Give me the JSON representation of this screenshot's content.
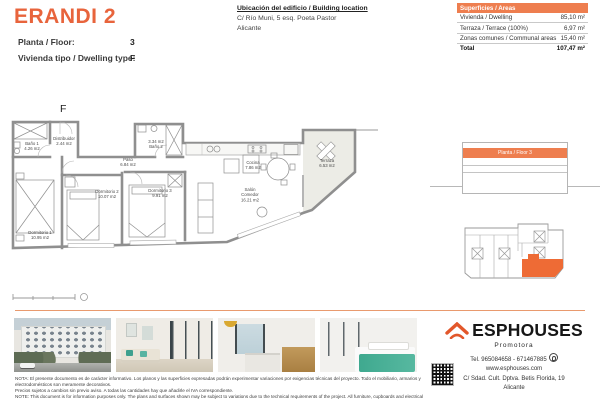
{
  "header": {
    "title": "ERANDI 2",
    "floor_label": "Planta / Floor:",
    "floor_value": "3",
    "type_label": "Vivienda tipo / Dwelling type:",
    "type_value": "F",
    "location_heading": "Ubicación del edificio / Building location",
    "location_line1": "C/ Río Muni, 5 esq. Poeta Pastor",
    "location_line2": "Alicante"
  },
  "areas_table": {
    "header": "Superficies / Areas",
    "rows": [
      {
        "label": "Vivienda / Dwelling",
        "value": "85,10 m²"
      },
      {
        "label": "Terraza / Terrace (100%)",
        "value": "6,97 m²"
      },
      {
        "label": "Zonas comunes / Communal areas",
        "value": "15,40 m²"
      }
    ],
    "total_label": "Total",
    "total_value": "107,47 m²"
  },
  "floorplan": {
    "unit_letter": "F",
    "rooms": {
      "bano1": {
        "name": "Baño 1",
        "area": "4.26 m2"
      },
      "distribuidor": {
        "name": "Distribuidor",
        "area": "2.44 m2"
      },
      "paso": {
        "name": "Paso",
        "area": "6.84 m2"
      },
      "bano2": {
        "area": "3.34 m2",
        "name": "Baño 2"
      },
      "cocina": {
        "name": "Cocina",
        "area": "7.86 m2"
      },
      "dormitorio1": {
        "name": "Dormitorio 1",
        "area": "10.95 m2"
      },
      "dormitorio2": {
        "name": "Dormitorio 2",
        "area": "10.07 m2"
      },
      "dormitorio3": {
        "name": "Dormitorio 3",
        "area": "9.91 m2"
      },
      "salon": {
        "name1": "Salón",
        "name2": "Comedor",
        "area": "16.21 m2"
      },
      "terraza": {
        "name": "Terraza",
        "area": "6.53 m2"
      }
    }
  },
  "side_panel": {
    "elevation_floor_label": "Planta / Floor 3"
  },
  "footer": {
    "brand": "ESPHOUSES",
    "brand_sub": "Promotora",
    "tel": "Tel. 965084658 - 671467885",
    "web": "www.esphouses.com",
    "address1": "C/ Sdad. Cult. Dptva. Betis Florida, 19",
    "address2": "Alicante",
    "note_es1": "NOTA: El presente documento es de carácter informativo. Los planos y las superficies expresadas podrán experimentar variaciones por exigencias técnicas del proyecto. Todo el mobiliario, armarios y electrodomésticos son meramente decorativos.",
    "note_es2": "Precios sujetos a cambios sin previo aviso. A todas las cantidades hay que añadirle el IVA correspondiente.",
    "note_en1": "NOTE: This document is for information purposes only. The plans and surfaces shown may be subject to variations due to the technical requirements of the project. All furniture, cupboards and electrical appliances are purely decorative.",
    "note_en2": "Prices subject to change without notice. VAT must be added to all amounts."
  },
  "colors": {
    "accent_orange": "#E8643C",
    "table_header_orange": "#EE7E4F",
    "keyplan_unit_orange": "#EE6B35",
    "separator_orange": "#E99A6E"
  }
}
